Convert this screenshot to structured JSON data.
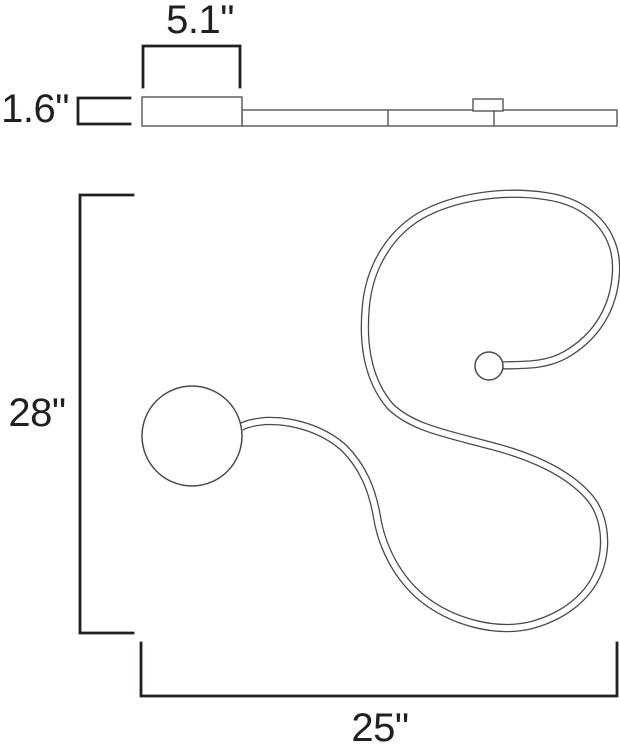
{
  "drawing": {
    "dimensions": {
      "canopy_width": "5.1\"",
      "fixture_depth": "1.6\"",
      "fixture_height": "28\"",
      "fixture_width": "25\""
    },
    "colors": {
      "background": "#ffffff",
      "dimension_lines": "#231f20",
      "drawing_outlines": "#565656"
    }
  }
}
